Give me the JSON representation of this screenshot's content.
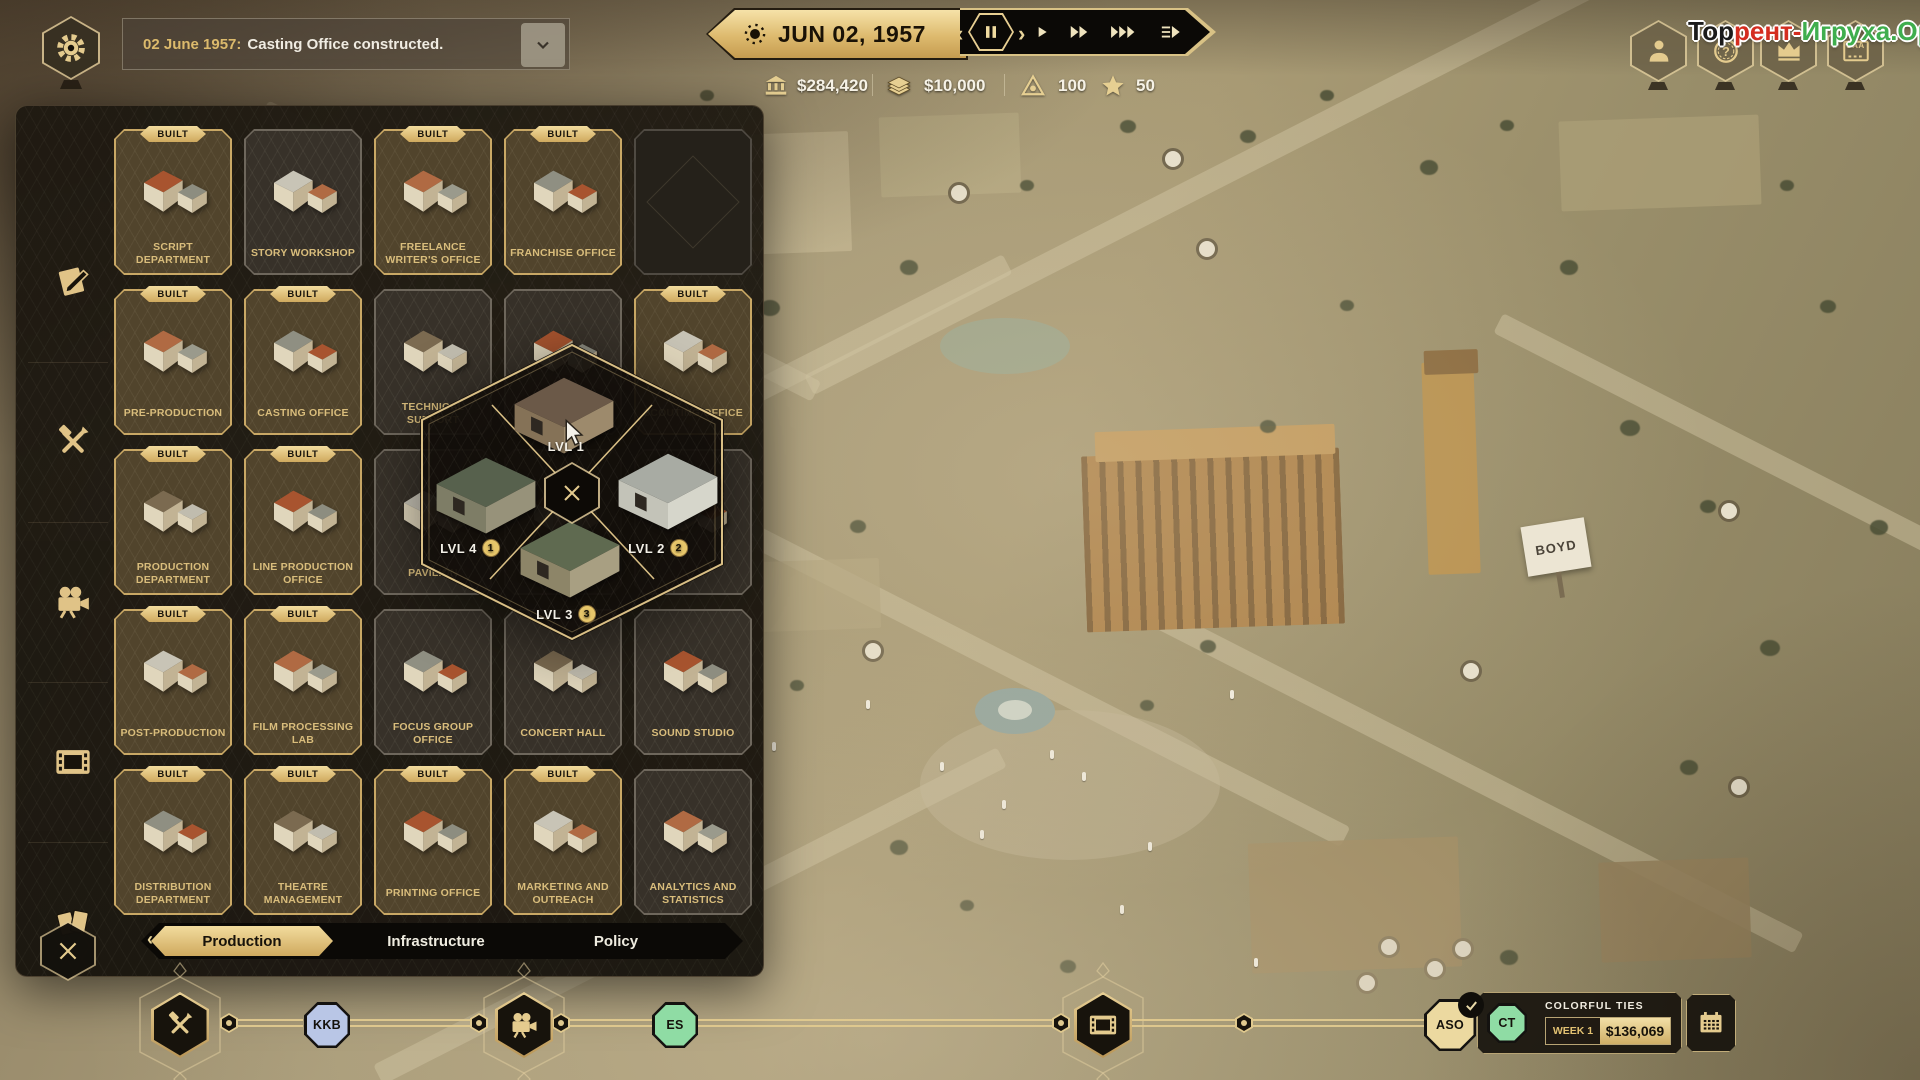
{
  "watermark": {
    "part_black": "Тор",
    "part_red": "рент-",
    "part_green": "Игруха.Орг",
    "color_black": "#1b1b1b",
    "color_red": "#d42d20",
    "color_green": "#3fae4e"
  },
  "notification": {
    "date_prefix": "02 June 1957:",
    "message": "Casting Office constructed."
  },
  "datebar": {
    "date": "JUN 02, 1957",
    "controls": [
      {
        "name": "pause",
        "icon": "pause-icon",
        "active": true
      },
      {
        "name": "play-1x",
        "icon": "play-icon",
        "active": false
      },
      {
        "name": "play-2x",
        "icon": "ff-icon",
        "active": false
      },
      {
        "name": "play-3x",
        "icon": "fff-icon",
        "active": false
      },
      {
        "name": "skip-to-date",
        "icon": "skip-icon",
        "active": false
      }
    ]
  },
  "resources": [
    {
      "name": "treasury",
      "icon": "bank-icon",
      "value": "$284,420"
    },
    {
      "name": "cash",
      "icon": "cash-icon",
      "value": "$10,000"
    },
    {
      "name": "influence",
      "icon": "influence-icon",
      "value": "100"
    },
    {
      "name": "stars",
      "icon": "star-icon",
      "value": "50"
    }
  ],
  "top_right_buttons": [
    {
      "name": "profile",
      "icon": "person-icon",
      "label": ""
    },
    {
      "name": "coin-question",
      "icon": "coin-question-icon",
      "label": ""
    },
    {
      "name": "awards",
      "icon": "crown-icon",
      "label": ""
    },
    {
      "name": "certificate",
      "icon": "certificate-icon",
      "label": "SAA"
    }
  ],
  "build_menu": {
    "built_label": "BUILT",
    "categories": [
      {
        "name": "scripts",
        "icon": "script-icon"
      },
      {
        "name": "preproduction",
        "icon": "tools-icon"
      },
      {
        "name": "production",
        "icon": "camera-icon"
      },
      {
        "name": "postproduction",
        "icon": "film-icon"
      },
      {
        "name": "distribution",
        "icon": "tickets-icon"
      }
    ],
    "rows": [
      [
        {
          "name": "SCRIPT DEPARTMENT",
          "built": true,
          "locked": false
        },
        {
          "name": "STORY WORKSHOP",
          "built": false,
          "locked": false
        },
        {
          "name": "FREELANCE WRITER'S OFFICE",
          "built": true,
          "locked": false
        },
        {
          "name": "FRANCHISE OFFICE",
          "built": true,
          "locked": false
        },
        {
          "name": "",
          "built": false,
          "locked": true
        }
      ],
      [
        {
          "name": "PRE-PRODUCTION",
          "built": true,
          "locked": false
        },
        {
          "name": "CASTING OFFICE",
          "built": true,
          "locked": false
        },
        {
          "name": "TECHNICAL SUPPORT",
          "built": false,
          "locked": false
        },
        {
          "name": "",
          "built": false,
          "locked": false
        },
        {
          "name": "SCOUTING OFFICE",
          "built": true,
          "locked": false
        }
      ],
      [
        {
          "name": "PRODUCTION DEPARTMENT",
          "built": true,
          "locked": false
        },
        {
          "name": "LINE PRODUCTION OFFICE",
          "built": true,
          "locked": false
        },
        {
          "name": "PAVILION",
          "built": false,
          "locked": false
        },
        {
          "name": "",
          "built": false,
          "locked": false
        },
        {
          "name": "",
          "built": false,
          "locked": false
        }
      ],
      [
        {
          "name": "POST-PRODUCTION",
          "built": true,
          "locked": false
        },
        {
          "name": "FILM PROCESSING LAB",
          "built": true,
          "locked": false
        },
        {
          "name": "FOCUS GROUP OFFICE",
          "built": false,
          "locked": false
        },
        {
          "name": "CONCERT HALL",
          "built": false,
          "locked": false
        },
        {
          "name": "SOUND STUDIO",
          "built": false,
          "locked": false
        }
      ],
      [
        {
          "name": "DISTRIBUTION DEPARTMENT",
          "built": true,
          "locked": false
        },
        {
          "name": "THEATRE MANAGEMENT",
          "built": true,
          "locked": false
        },
        {
          "name": "PRINTING OFFICE",
          "built": true,
          "locked": false
        },
        {
          "name": "MARKETING AND OUTREACH",
          "built": true,
          "locked": false
        },
        {
          "name": "ANALYTICS AND STATISTICS",
          "built": false,
          "locked": false
        }
      ]
    ],
    "tabs": [
      {
        "label": "Production",
        "active": true
      },
      {
        "label": "Infrastructure",
        "active": false
      },
      {
        "label": "Policy",
        "active": false
      }
    ]
  },
  "level_selector": {
    "options": [
      {
        "label": "LVL 1",
        "pos": "top",
        "badge": ""
      },
      {
        "label": "LVL 2",
        "pos": "right",
        "badge": "2"
      },
      {
        "label": "LVL 3",
        "pos": "bottom",
        "badge": "3"
      },
      {
        "label": "LVL 4",
        "pos": "left",
        "badge": "1"
      }
    ]
  },
  "pipeline": {
    "stages": [
      {
        "name": "preproduction",
        "icon": "tools-icon"
      },
      {
        "name": "production",
        "icon": "camera-icon"
      },
      {
        "name": "postproduction",
        "icon": "film-icon"
      }
    ],
    "projects": [
      {
        "code": "KKB",
        "color": "#b9c6e6",
        "completed": false
      },
      {
        "code": "ES",
        "color": "#8fdca4",
        "completed": false
      },
      {
        "code": "ASO",
        "color": "#ecd9a0",
        "completed": true
      }
    ],
    "release_panel": {
      "code": "CT",
      "color": "#8fdca4",
      "title": "COLORFUL TIES",
      "week": "WEEK 1",
      "amount": "$136,069"
    }
  },
  "map": {
    "billboard": "BOYD"
  }
}
